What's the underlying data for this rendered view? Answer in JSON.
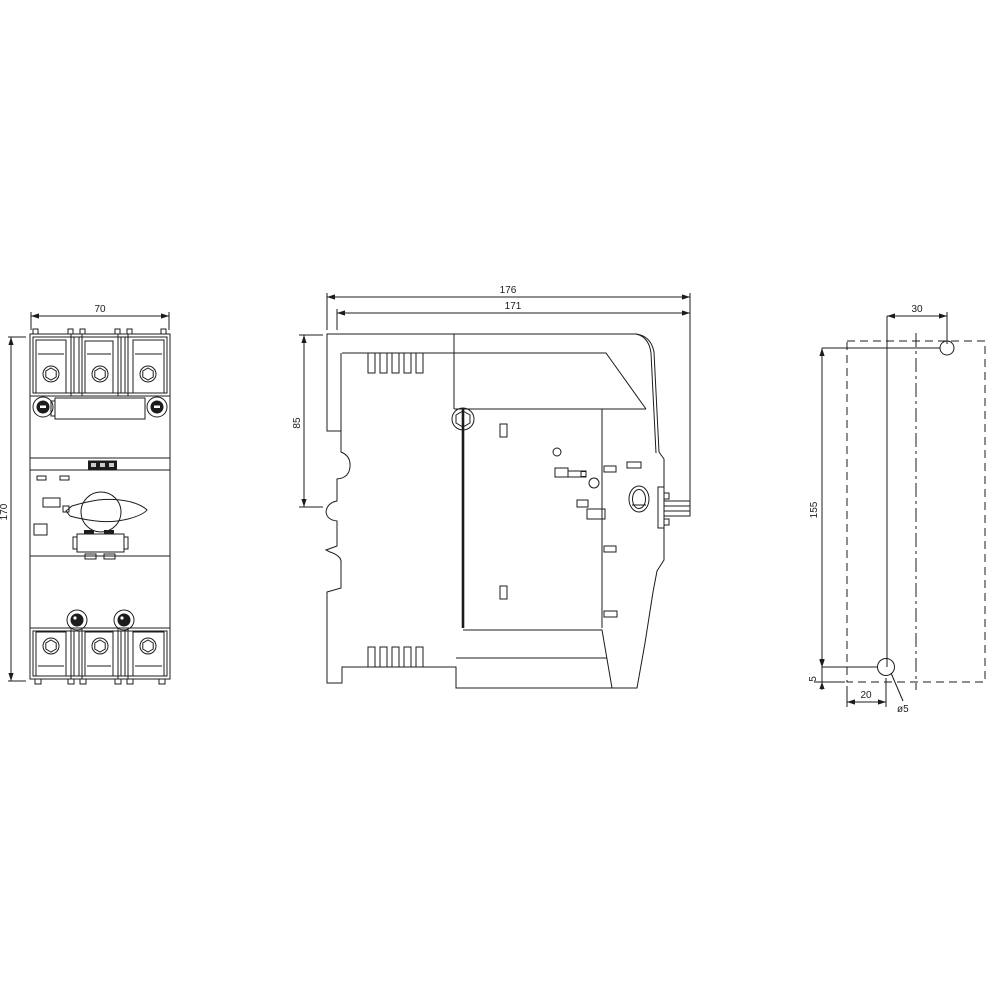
{
  "drawing": {
    "type": "technical-dimension-drawing",
    "background": "#ffffff",
    "line_color": "#1c1c1c",
    "front_view": {
      "dim_width": "70",
      "dim_height": "170"
    },
    "side_view": {
      "dim_depth_total": "176",
      "dim_depth_body": "171",
      "dim_top_to_rail": "85"
    },
    "drill_plan": {
      "dim_hole_offset_x": "30",
      "dim_hole_spacing": "155",
      "dim_bottom_offset": "5",
      "dim_edge_offset": "20",
      "hole_diameter": "ø5"
    }
  }
}
